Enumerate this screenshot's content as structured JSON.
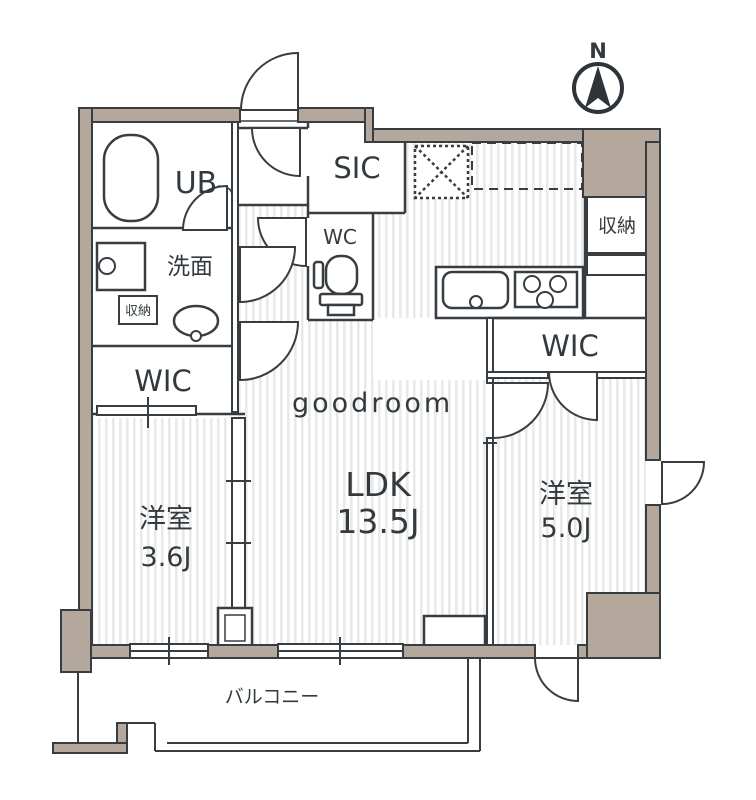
{
  "compass": {
    "north": "N"
  },
  "watermark": "goodroom",
  "rooms": {
    "ub": "UB",
    "washroom": "洗面",
    "storage_small": "収納",
    "wic_left": "WIC",
    "sic": "SIC",
    "wc": "WC",
    "storage_right": "収納",
    "wic_right": "WIC",
    "ldk": {
      "name": "LDK",
      "size": "13.5J"
    },
    "bedroom_left": {
      "name": "洋室",
      "size": "3.6J"
    },
    "bedroom_right": {
      "name": "洋室",
      "size": "5.0J"
    },
    "balcony": "バルコニー"
  },
  "colors": {
    "wall_fill": "#b4a89c",
    "line": "#383d41",
    "hatch_stripe": "#e9e9e9",
    "text": "#333a3e"
  }
}
